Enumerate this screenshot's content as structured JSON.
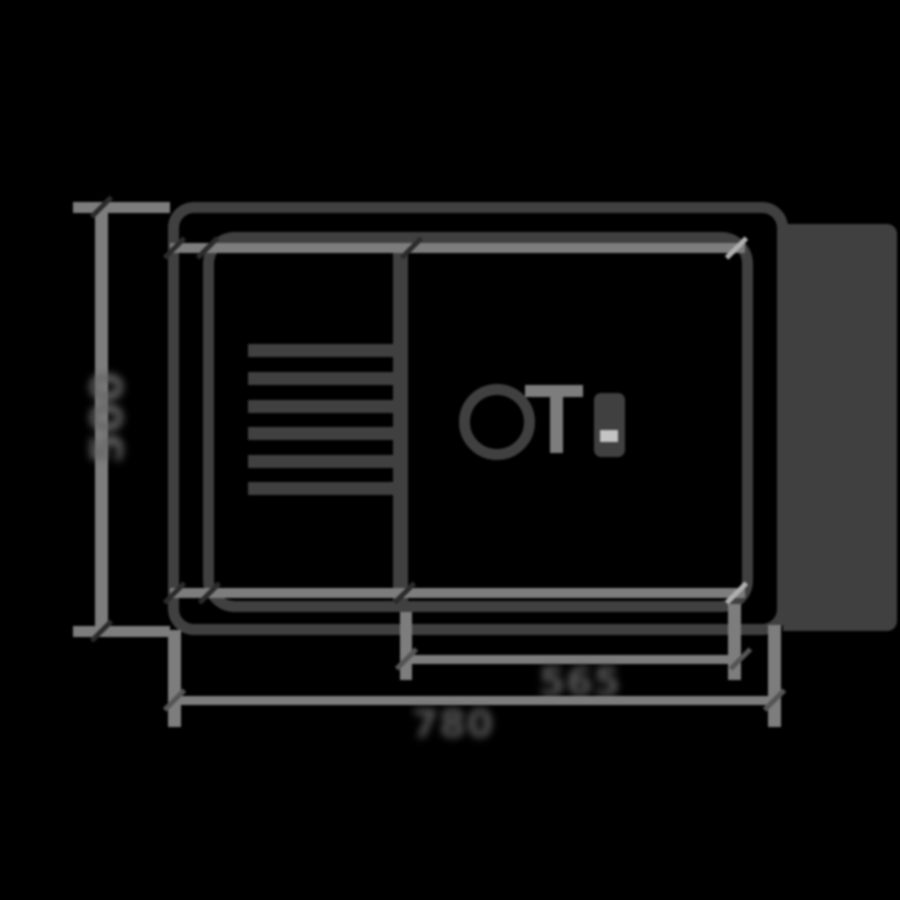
{
  "drawing": {
    "type": "sink-top-view-technical-drawing",
    "labels": {
      "height": "500",
      "bowl_width": "565",
      "overall_width": "780"
    },
    "colors": {
      "background": "#000000",
      "line_dark": "#404040",
      "line_dimension": "#7d7d7d",
      "label_text": "#5a5a5a",
      "notch_highlight": "#c4c4c4"
    },
    "parts": [
      "outer-rim",
      "inner-bowl",
      "bowl-divider",
      "drainboard-ridges",
      "drain-hole",
      "tap-hole-marking",
      "accessory-marking",
      "right-side-block"
    ]
  }
}
